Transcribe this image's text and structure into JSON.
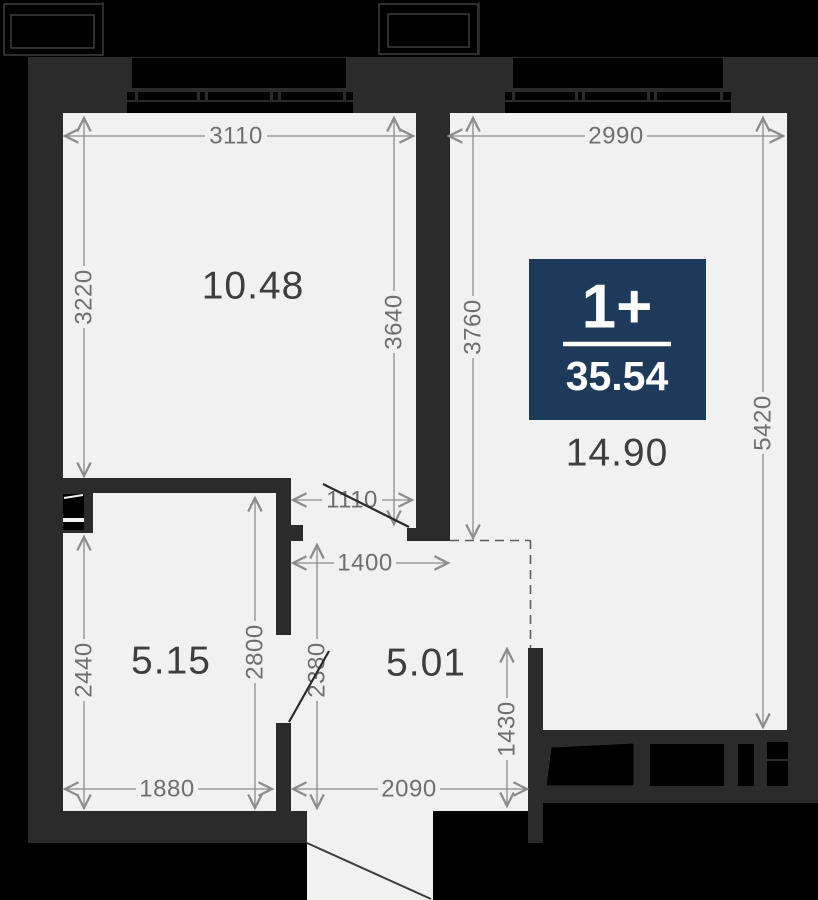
{
  "badge": {
    "rooms_label": "1+",
    "total_area": "35.54"
  },
  "rooms": {
    "living": "10.48",
    "bedroom": "14.90",
    "bathroom": "5.15",
    "hallway": "5.01"
  },
  "dims": {
    "room1_width": "3110",
    "room2_width": "2990",
    "room1_height_left": "3220",
    "room1_height_right": "3640",
    "room2_height_left": "3760",
    "room2_height_right": "5420",
    "door_opening": "1110",
    "hall_width": "1400",
    "hall_height_left": "2800",
    "hall_height_mid": "2380",
    "bath_height": "2440",
    "bath_width": "1880",
    "hall_bottom_width": "2090",
    "entry_wall_height": "1430"
  },
  "colors": {
    "badge_bg": "#1e3a5a",
    "wall": "#2b2b2b",
    "floor": "#f1f1f2",
    "outside": "#000000",
    "dim_text": "#6f6f6f"
  }
}
